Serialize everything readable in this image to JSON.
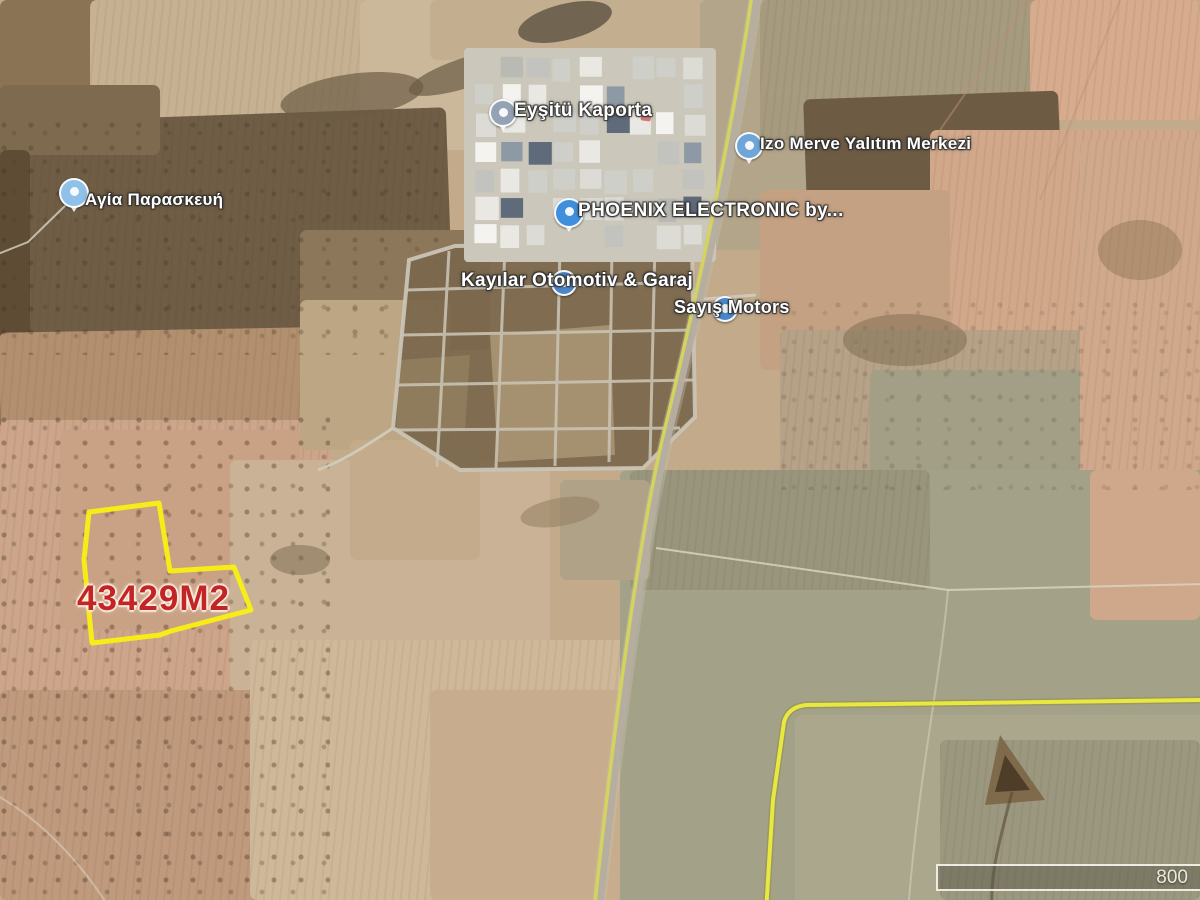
{
  "parcel": {
    "area_label": "43429M2",
    "outline_color": "#f8ee15",
    "label_color": "#c32425"
  },
  "pois": {
    "agia_paraskevi": "Αγία Παρασκευή",
    "kaporta": "Eyşitü Kaporta",
    "izo_merve": "Izo Merve Yalıtım Merkezi",
    "phoenix": "PHOENIX ELECTRONIC by...",
    "kayilar": "Kayılar Otomotiv & Garaj",
    "sayis": "Sayış Motors"
  },
  "scale_bar": {
    "distance": "800"
  },
  "colors": {
    "road_line_yellow": "#d5d55c",
    "boundary_road_yellow": "#ecec3e",
    "road_gray": "#b5aea0"
  }
}
